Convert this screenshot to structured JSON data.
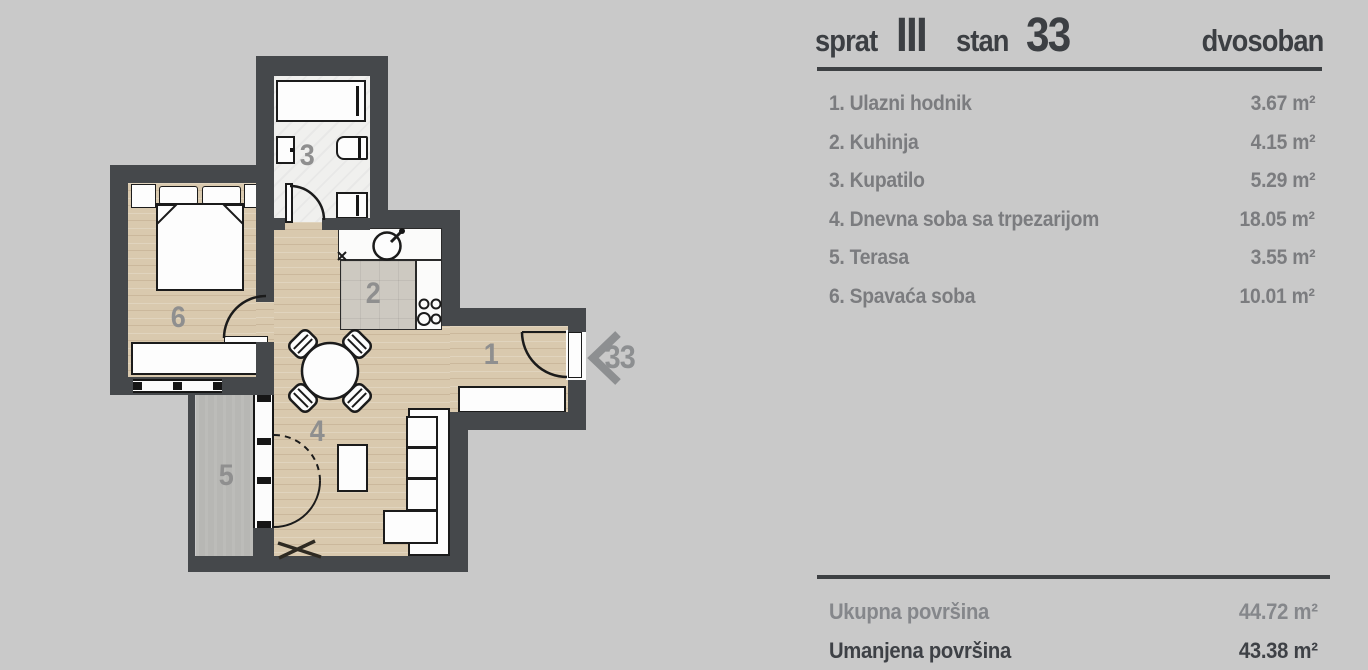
{
  "header": {
    "floor_label": "sprat",
    "floor_number": "III",
    "unit_label": "stan",
    "unit_number": "33",
    "apartment_type": "dvosoban"
  },
  "rooms": [
    {
      "num": "1",
      "name": "1. Ulazni hodnik",
      "area": "3.67 m²"
    },
    {
      "num": "2",
      "name": "2. Kuhinja",
      "area": "4.15 m²"
    },
    {
      "num": "3",
      "name": "3. Kupatilo",
      "area": "5.29 m²"
    },
    {
      "num": "4",
      "name": "4. Dnevna soba sa trpezarijom",
      "area": "18.05 m²"
    },
    {
      "num": "5",
      "name": "5. Terasa",
      "area": "3.55 m²"
    },
    {
      "num": "6",
      "name": "6. Spavaća soba",
      "area": "10.01 m²"
    }
  ],
  "totals": {
    "gross_label": "Ukupna površina",
    "gross_value": "44.72 m²",
    "net_label": "Umanjena površina",
    "net_value": "43.38 m²"
  },
  "plan": {
    "entrance_unit_number": "33"
  },
  "colors": {
    "background": "#c9c9c9",
    "wall": "#45484b",
    "wood_floor": "#d9c9ae",
    "terrace_concrete": "#b7b7b4",
    "header_text": "#3c3f43",
    "list_text": "#7b7c7f",
    "net_total_text": "#3e4146",
    "plan_label": "#8f8f8f"
  }
}
